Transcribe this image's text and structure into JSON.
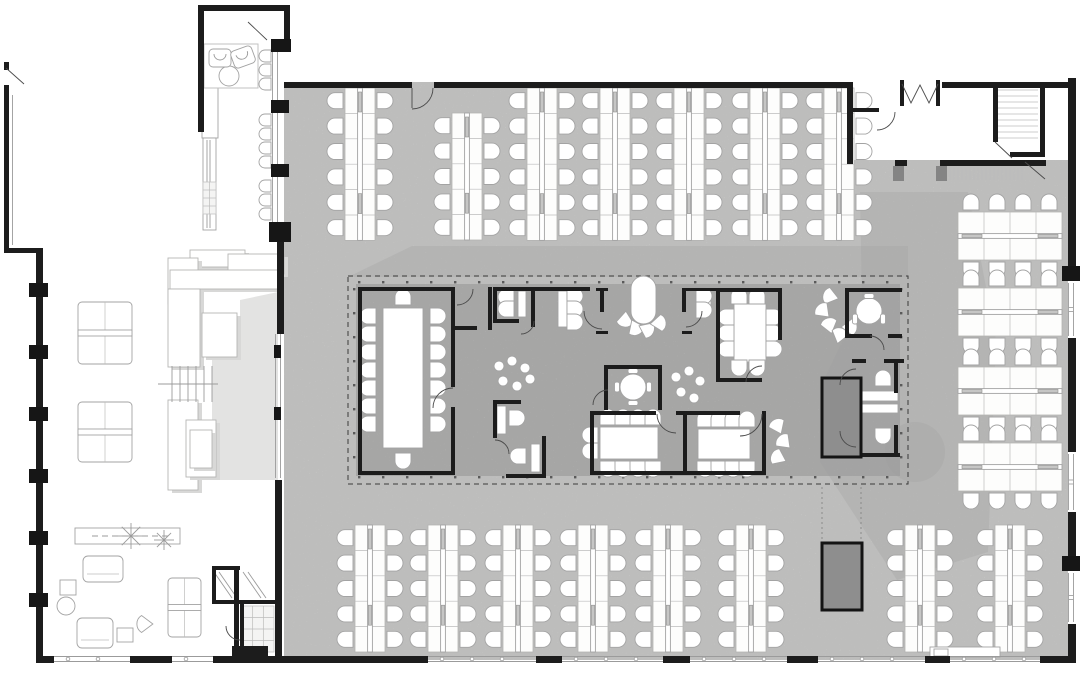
{
  "app": {
    "name": "office-floor-plan",
    "view": "plan"
  },
  "colors": {
    "background": "#ffffff",
    "floor_open_office": "#e3e3e2",
    "floor_core_block": "#c7c7c6",
    "walls": "#1c1c1c",
    "shadow_band": "#9e9e9e",
    "dark_service_block": "#8e8e8e",
    "furniture_outline": "#a3a3a3"
  },
  "canvas": {
    "width": 1080,
    "height": 673
  },
  "floors": {
    "main": "M284,82 H847 V160 H1068 V660 H284 Z",
    "annex_patch": "M212,480 V360 L240,332 V300 L278,292 V480 Z",
    "core": [
      356,
      284,
      544,
      192
    ]
  },
  "shadows": [
    "M348,277 L412,246 L908,246 L908,277 Z",
    "M860,192 L968,192 L996,340 L988,552 L897,580 L820,462 L820,388 L862,300 Z"
  ],
  "shadow_lobe": [
    915,
    452,
    30
  ],
  "walls": [
    [
      284,
      82,
      128,
      6
    ],
    [
      434,
      82,
      415,
      6
    ],
    [
      847,
      82,
      6,
      82
    ],
    [
      853,
      108,
      26,
      4
    ],
    [
      895,
      160,
      12,
      6
    ],
    [
      940,
      160,
      106,
      6
    ],
    [
      900,
      80,
      4,
      26
    ],
    [
      936,
      80,
      4,
      26
    ],
    [
      942,
      82,
      128,
      6
    ],
    [
      993,
      82,
      5,
      60
    ],
    [
      1010,
      152,
      32,
      5
    ],
    [
      1040,
      82,
      5,
      75
    ],
    [
      1068,
      78,
      8,
      188
    ],
    [
      1068,
      338,
      8,
      114
    ],
    [
      1068,
      512,
      8,
      44
    ],
    [
      1068,
      624,
      8,
      38
    ],
    [
      36,
      656,
      18,
      7
    ],
    [
      130,
      656,
      42,
      7
    ],
    [
      213,
      656,
      215,
      7
    ],
    [
      536,
      656,
      26,
      7
    ],
    [
      663,
      656,
      27,
      7
    ],
    [
      787,
      656,
      31,
      7
    ],
    [
      925,
      656,
      25,
      7
    ],
    [
      1040,
      656,
      36,
      7
    ],
    [
      36,
      253,
      7,
      403
    ],
    [
      4,
      85,
      5,
      168
    ],
    [
      4,
      248,
      39,
      5
    ],
    [
      4,
      62,
      5,
      8
    ],
    [
      198,
      5,
      6,
      127
    ],
    [
      198,
      5,
      92,
      6
    ],
    [
      284,
      5,
      6,
      36
    ],
    [
      277,
      242,
      7,
      92
    ],
    [
      275,
      480,
      7,
      178
    ],
    [
      358,
      287,
      4,
      188
    ],
    [
      358,
      287,
      97,
      4
    ],
    [
      451,
      287,
      4,
      100
    ],
    [
      451,
      407,
      4,
      68
    ],
    [
      358,
      471,
      97,
      4
    ],
    [
      488,
      287,
      4,
      43
    ],
    [
      455,
      326,
      22,
      4
    ],
    [
      493,
      287,
      97,
      4
    ],
    [
      493,
      287,
      4,
      36
    ],
    [
      493,
      319,
      26,
      4
    ],
    [
      531,
      287,
      4,
      40
    ],
    [
      596,
      288,
      12,
      3
    ],
    [
      600,
      288,
      4,
      24
    ],
    [
      596,
      331,
      12,
      3
    ],
    [
      682,
      288,
      38,
      3
    ],
    [
      682,
      288,
      4,
      24
    ],
    [
      682,
      331,
      10,
      3
    ],
    [
      716,
      288,
      4,
      94
    ],
    [
      716,
      288,
      66,
      4
    ],
    [
      778,
      288,
      4,
      52
    ],
    [
      716,
      378,
      46,
      4
    ],
    [
      845,
      288,
      57,
      4
    ],
    [
      845,
      288,
      4,
      50
    ],
    [
      845,
      334,
      27,
      4
    ],
    [
      888,
      334,
      14,
      4
    ],
    [
      604,
      365,
      58,
      4
    ],
    [
      604,
      365,
      4,
      45
    ],
    [
      658,
      365,
      4,
      45
    ],
    [
      493,
      400,
      4,
      38
    ],
    [
      493,
      400,
      28,
      4
    ],
    [
      542,
      436,
      4,
      42
    ],
    [
      506,
      474,
      40,
      4
    ],
    [
      590,
      411,
      66,
      4
    ],
    [
      676,
      411,
      64,
      4
    ],
    [
      590,
      411,
      4,
      64
    ],
    [
      683,
      411,
      4,
      64
    ],
    [
      590,
      471,
      176,
      4
    ],
    [
      762,
      411,
      4,
      64
    ],
    [
      852,
      359,
      14,
      4
    ],
    [
      884,
      359,
      20,
      4
    ],
    [
      894,
      363,
      4,
      30
    ],
    [
      894,
      425,
      4,
      30
    ],
    [
      852,
      453,
      48,
      4
    ],
    [
      234,
      566,
      5,
      92
    ],
    [
      212,
      566,
      4,
      38
    ],
    [
      212,
      566,
      28,
      4
    ],
    [
      212,
      600,
      30,
      4
    ],
    [
      240,
      600,
      38,
      4
    ],
    [
      240,
      602,
      4,
      56
    ],
    [
      232,
      646,
      36,
      12
    ]
  ],
  "columns": [
    [
      29,
      283,
      19,
      14
    ],
    [
      29,
      345,
      19,
      14
    ],
    [
      29,
      407,
      19,
      14
    ],
    [
      29,
      469,
      19,
      14
    ],
    [
      29,
      531,
      19,
      14
    ],
    [
      29,
      593,
      19,
      14
    ],
    [
      271,
      39,
      20,
      13
    ],
    [
      271,
      100,
      18,
      13
    ],
    [
      271,
      164,
      18,
      13
    ],
    [
      269,
      222,
      22,
      20
    ],
    [
      1062,
      266,
      20,
      15
    ],
    [
      1062,
      556,
      20,
      15
    ],
    [
      274,
      345,
      7,
      13
    ],
    [
      274,
      407,
      7,
      13
    ]
  ],
  "jambs": [
    [
      893,
      166,
      11,
      15
    ],
    [
      936,
      166,
      11,
      15
    ]
  ],
  "dark_blocks": [
    [
      822,
      378,
      39,
      79
    ],
    [
      822,
      543,
      40,
      67
    ]
  ],
  "dashed_rect": [
    348,
    276,
    560,
    208
  ],
  "clusters_v": [
    [
      345,
      88,
      6
    ],
    [
      452,
      113,
      5
    ],
    [
      527,
      88,
      6
    ],
    [
      600,
      88,
      6
    ],
    [
      674,
      88,
      6
    ],
    [
      750,
      88,
      6
    ],
    [
      824,
      88,
      6
    ],
    [
      355,
      525,
      5
    ],
    [
      428,
      525,
      5
    ],
    [
      503,
      525,
      5
    ],
    [
      578,
      525,
      5
    ],
    [
      653,
      525,
      5
    ],
    [
      736,
      525,
      5
    ],
    [
      905,
      525,
      5
    ],
    [
      995,
      525,
      5
    ]
  ],
  "clusters_h": [
    [
      958,
      212
    ],
    [
      958,
      288
    ],
    [
      958,
      367
    ],
    [
      958,
      443
    ]
  ],
  "tables": {
    "rects": [
      [
        383,
        308,
        40,
        140
      ],
      [
        734,
        304,
        32,
        58
      ],
      [
        600,
        427,
        58,
        32
      ],
      [
        698,
        429,
        52,
        30
      ],
      [
        518,
        291,
        8,
        26
      ],
      [
        558,
        291,
        9,
        36
      ],
      [
        703,
        292,
        8,
        24
      ],
      [
        497,
        406,
        9,
        28
      ],
      [
        531,
        444,
        9,
        28
      ],
      [
        856,
        391,
        42,
        10
      ],
      [
        856,
        404,
        42,
        9
      ],
      [
        60,
        580,
        16,
        15
      ],
      [
        117,
        628,
        16,
        14
      ],
      [
        80,
        532,
        8,
        8
      ],
      [
        202,
        88,
        16,
        50
      ],
      [
        203,
        138,
        13,
        92
      ]
    ],
    "capsule": [
      631,
      276,
      25,
      48
    ],
    "cross": [
      [
        78,
        302,
        54,
        62
      ],
      [
        78,
        402,
        54,
        60
      ],
      [
        168,
        578,
        33,
        59
      ]
    ],
    "sofas": [
      [
        83,
        556,
        40,
        26
      ],
      [
        77,
        618,
        36,
        30
      ]
    ],
    "shelf": [
      75,
      528,
      105,
      16
    ],
    "outline": [
      204,
      44,
      54,
      44
    ]
  },
  "white_patches": [
    [
      930,
      647,
      70,
      10
    ],
    [
      934,
      649,
      14,
      7
    ]
  ],
  "circles": [
    [
      229,
      76,
      10
    ],
    [
      633,
      387,
      13
    ],
    [
      869,
      311,
      13
    ],
    [
      66,
      606,
      9
    ]
  ],
  "chairs": [
    [
      "d",
      371,
      316,
      0
    ],
    [
      "d",
      371,
      334,
      0
    ],
    [
      "d",
      371,
      352,
      0
    ],
    [
      "d",
      371,
      370,
      0
    ],
    [
      "d",
      371,
      388,
      0
    ],
    [
      "d",
      371,
      406,
      0
    ],
    [
      "d",
      371,
      424,
      0
    ],
    [
      "d",
      435,
      316,
      180
    ],
    [
      "d",
      435,
      334,
      180
    ],
    [
      "d",
      435,
      352,
      180
    ],
    [
      "d",
      435,
      370,
      180
    ],
    [
      "d",
      435,
      388,
      180
    ],
    [
      "d",
      435,
      406,
      180
    ],
    [
      "d",
      435,
      424,
      180
    ],
    [
      "d",
      403,
      300,
      90
    ],
    [
      "d",
      403,
      458,
      270
    ],
    [
      "d",
      739,
      299,
      90
    ],
    [
      "d",
      757,
      299,
      90
    ],
    [
      "d",
      739,
      365,
      270
    ],
    [
      "d",
      757,
      365,
      270
    ],
    [
      "d",
      729,
      317,
      0
    ],
    [
      "d",
      729,
      333,
      0
    ],
    [
      "d",
      729,
      349,
      0
    ],
    [
      "d",
      771,
      317,
      180
    ],
    [
      "d",
      771,
      333,
      180
    ],
    [
      "d",
      771,
      349,
      180
    ],
    [
      "d",
      608,
      420,
      90
    ],
    [
      "d",
      623,
      420,
      90
    ],
    [
      "d",
      638,
      420,
      90
    ],
    [
      "d",
      653,
      420,
      90
    ],
    [
      "d",
      608,
      466,
      270
    ],
    [
      "d",
      623,
      466,
      270
    ],
    [
      "d",
      638,
      466,
      270
    ],
    [
      "d",
      653,
      466,
      270
    ],
    [
      "d",
      593,
      435,
      0
    ],
    [
      "d",
      593,
      451,
      0
    ],
    [
      "d",
      705,
      422,
      90
    ],
    [
      "d",
      719,
      422,
      90
    ],
    [
      "d",
      733,
      422,
      90
    ],
    [
      "d",
      747,
      422,
      90
    ],
    [
      "d",
      705,
      466,
      270
    ],
    [
      "d",
      719,
      466,
      270
    ],
    [
      "d",
      733,
      466,
      270
    ],
    [
      "d",
      747,
      466,
      270
    ],
    [
      "d",
      572,
      296,
      180
    ],
    [
      "d",
      572,
      309,
      180
    ],
    [
      "d",
      572,
      322,
      180
    ],
    [
      "d",
      509,
      297,
      0
    ],
    [
      "d",
      509,
      309,
      0
    ],
    [
      "d",
      701,
      296,
      180
    ],
    [
      "d",
      701,
      310,
      180
    ],
    [
      "d",
      514,
      418,
      180
    ],
    [
      "d",
      521,
      456,
      0
    ],
    [
      "d",
      883,
      381,
      90
    ],
    [
      "d",
      883,
      433,
      270
    ],
    [
      "stool",
      267,
      56,
      0
    ],
    [
      "stool",
      267,
      70,
      0
    ],
    [
      "stool",
      267,
      84,
      0
    ],
    [
      "stool",
      267,
      120,
      0
    ],
    [
      "stool",
      267,
      134,
      0
    ],
    [
      "stool",
      267,
      148,
      0
    ],
    [
      "stool",
      267,
      162,
      0
    ],
    [
      "stool",
      267,
      186,
      0
    ],
    [
      "stool",
      267,
      200,
      0
    ],
    [
      "stool",
      267,
      214,
      0
    ],
    [
      "fan",
      829,
      296,
      -30
    ],
    [
      "fan",
      822,
      310,
      0
    ],
    [
      "fan",
      829,
      324,
      30
    ],
    [
      "fan",
      840,
      334,
      60
    ],
    [
      "fan",
      851,
      327,
      135
    ],
    [
      "fan",
      777,
      425,
      20
    ],
    [
      "fan",
      783,
      441,
      0
    ],
    [
      "fan",
      777,
      457,
      -20
    ],
    [
      "fan",
      143,
      624,
      -45
    ],
    [
      "fan",
      625,
      321,
      230
    ],
    [
      "fan",
      636,
      329,
      200
    ],
    [
      "fan",
      648,
      330,
      160
    ],
    [
      "fan",
      660,
      323,
      130
    ],
    [
      "blob",
      499,
      366,
      0
    ],
    [
      "blob",
      512,
      361,
      0
    ],
    [
      "blob",
      525,
      368,
      0
    ],
    [
      "blob",
      503,
      381,
      0
    ],
    [
      "blob",
      517,
      386,
      0
    ],
    [
      "blob",
      530,
      379,
      0
    ],
    [
      "blob",
      676,
      377,
      0
    ],
    [
      "blob",
      689,
      371,
      0
    ],
    [
      "blob",
      700,
      381,
      0
    ],
    [
      "blob",
      681,
      392,
      0
    ],
    [
      "blob",
      694,
      398,
      0
    ],
    [
      "tab",
      633,
      371,
      0
    ],
    [
      "tab",
      633,
      403,
      0
    ],
    [
      "tab",
      617,
      387,
      90
    ],
    [
      "tab",
      649,
      387,
      90
    ],
    [
      "tab",
      869,
      296,
      0
    ],
    [
      "tab",
      855,
      319,
      90
    ],
    [
      "tab",
      883,
      319,
      90
    ],
    [
      "arm",
      220,
      58,
      180
    ],
    [
      "arm",
      243,
      57,
      160
    ]
  ],
  "doors": {
    "arcs": [
      "M433,88 A21,21 0 0 1 412,109",
      "M895,112 A18,18 0 0 1 877,130",
      "M453,388 A20,20 0 0 0 433,408",
      "M584,311 A18,18 0 0 0 602,329",
      "M702,311 A16,16 0 0 1 686,327",
      "M473,289 A16,16 0 0 1 457,305",
      "M608,390 A15,15 0 0 0 593,405",
      "M762,366 A16,16 0 0 0 746,382",
      "M657,414 A19,19 0 0 0 676,433",
      "M762,414 A22,22 0 0 1 740,436",
      "M870,336 A14,14 0 0 1 884,350",
      "M856,369 A16,16 0 0 0 840,385",
      "M856,447 A16,16 0 0 1 840,431",
      "M226,626 A14,14 0 0 0 240,640",
      "M534,321 A13,13 0 0 1 521,334",
      "M495,440 A14,14 0 0 1 509,454"
    ],
    "leaves": [
      [
        412,
        88,
        412,
        108
      ],
      [
        248,
        22,
        267,
        40
      ],
      [
        6,
        68,
        24,
        84
      ],
      [
        995,
        142,
        1012,
        158
      ],
      [
        1025,
        162,
        1045,
        179
      ]
    ],
    "mdoor": [
      902,
      84,
      911,
      103,
      920,
      85,
      929,
      103,
      938,
      84
    ]
  },
  "lines": [
    [
      207,
      140,
      207,
      228
    ],
    [
      210,
      140,
      210,
      228
    ],
    [
      158,
      384,
      218,
      384
    ],
    [
      214,
      572,
      232,
      598
    ],
    [
      219,
      572,
      237,
      598
    ],
    [
      243,
      572,
      261,
      598
    ],
    [
      248,
      572,
      266,
      598
    ]
  ],
  "dashlines": [
    [
      92,
      536,
      170,
      536
    ]
  ],
  "dotted": [
    [
      822,
      487,
      822,
      542
    ],
    [
      861,
      487,
      861,
      542
    ]
  ],
  "doubles": {
    "plain": [
      [
        275,
        51,
        275,
        100
      ],
      [
        275,
        113,
        275,
        164
      ],
      [
        275,
        177,
        275,
        222
      ],
      [
        278,
        334,
        278,
        478
      ],
      [
        10,
        95,
        10,
        245
      ]
    ],
    "win_bottom": [
      [
        54,
        659,
        130,
        659
      ],
      [
        172,
        659,
        213,
        659
      ],
      [
        428,
        659,
        536,
        659
      ],
      [
        562,
        659,
        663,
        659
      ],
      [
        690,
        659,
        787,
        659
      ],
      [
        818,
        659,
        925,
        659
      ],
      [
        950,
        659,
        1040,
        659
      ]
    ],
    "win_right": [
      [
        1071,
        283,
        1071,
        336
      ],
      [
        1071,
        454,
        1071,
        510
      ],
      [
        1071,
        573,
        1071,
        622
      ]
    ]
  },
  "hatches": [
    [
      998,
      90,
      40,
      52,
      "h",
      6
    ],
    [
      950,
      168,
      72,
      12,
      "v",
      4
    ]
  ],
  "grids": [
    [
      203,
      182,
      13,
      32,
      2,
      4
    ],
    [
      242,
      606,
      32,
      46,
      3,
      4
    ]
  ],
  "treads": {
    "xs": [
      172,
      180,
      188,
      196,
      204,
      212
    ],
    "y1": 366,
    "y2": 402
  },
  "steps": [
    [
      190,
      250,
      55,
      17
    ],
    [
      228,
      254,
      56,
      20
    ],
    [
      168,
      258,
      30,
      46
    ],
    [
      170,
      270,
      110,
      19
    ],
    [
      168,
      289,
      32,
      78
    ],
    [
      202,
      313,
      35,
      44
    ],
    [
      168,
      400,
      30,
      90
    ],
    [
      186,
      420,
      30,
      57
    ],
    [
      190,
      430,
      22,
      38
    ]
  ],
  "plants": [
    [
      131,
      536,
      13
    ],
    [
      164,
      540,
      10
    ]
  ]
}
